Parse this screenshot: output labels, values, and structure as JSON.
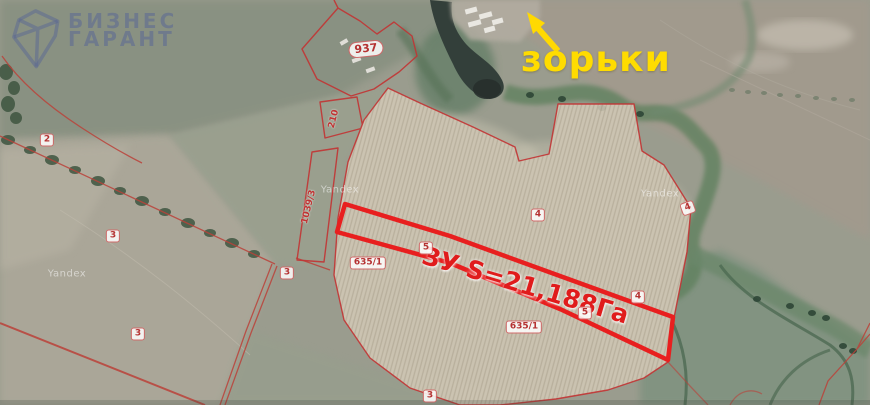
{
  "logo": {
    "line1": "БИЗНЕС",
    "line2": "ГАРАНТ"
  },
  "map": {
    "provider_watermark": "Yandex",
    "callout": {
      "text": "зорьки"
    },
    "highlighted_parcel": {
      "label": "ЗУ S=21,188Га"
    },
    "parcel_labels": [
      "2",
      "3",
      "3",
      "3",
      "3",
      "937",
      "210",
      "1039/3",
      "635/1",
      "635/1",
      "4",
      "4",
      "4",
      "5",
      "5"
    ]
  },
  "icons": {
    "logo_gem": "gem-outline",
    "callout_arrow": "arrow-up-left"
  },
  "colors": {
    "parcel_line": "#c23434",
    "highlight_outline": "#e81f1f",
    "callout_text": "#ffdc00",
    "logo_text": "#556496",
    "field": "#cbc3b1",
    "water": "#333f3a"
  }
}
